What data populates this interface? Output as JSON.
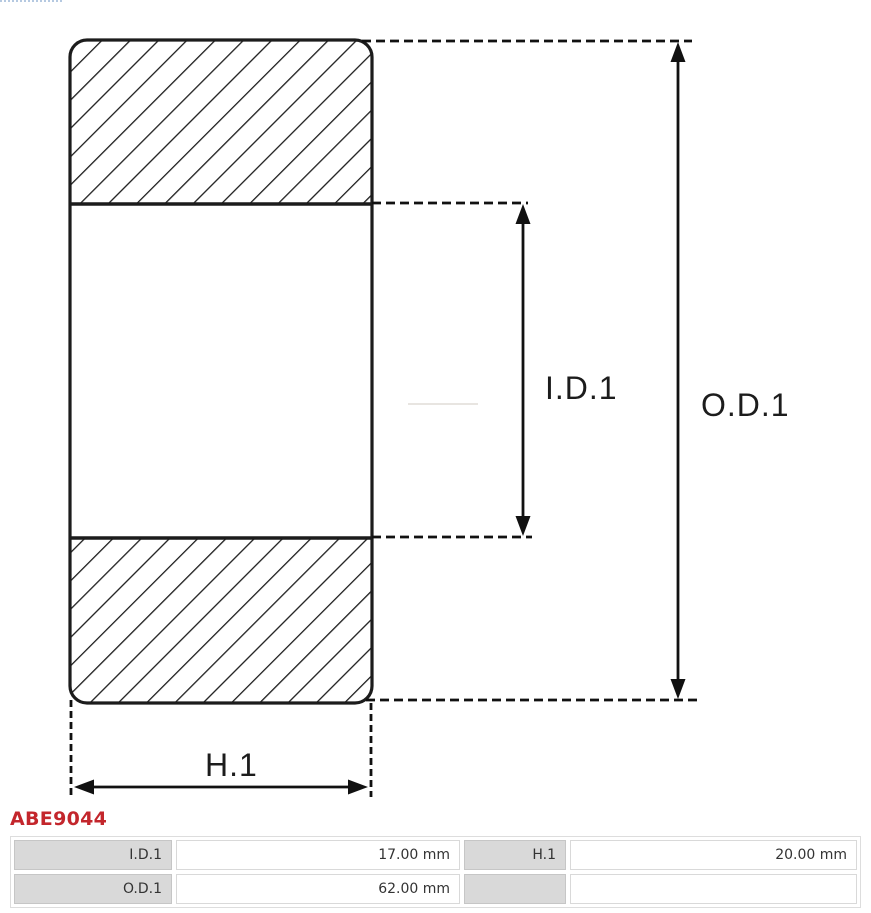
{
  "colors": {
    "line": "#1c1c1c",
    "product_code": "#c3262c",
    "table_label_bg": "#d9d9d9",
    "table_border": "#cccccc"
  },
  "diagram": {
    "labels": {
      "inner_diameter": "I.D.1",
      "outer_diameter": "O.D.1",
      "height": "H.1"
    }
  },
  "product": {
    "code": "ABE9044"
  },
  "spec_table": {
    "rows": [
      {
        "cells": [
          {
            "label": "I.D.1",
            "value": "17.00 mm"
          },
          {
            "label": "H.1",
            "value": "20.00 mm"
          }
        ]
      },
      {
        "cells": [
          {
            "label": "O.D.1",
            "value": "62.00 mm"
          },
          {
            "label": "",
            "value": ""
          }
        ]
      }
    ]
  }
}
